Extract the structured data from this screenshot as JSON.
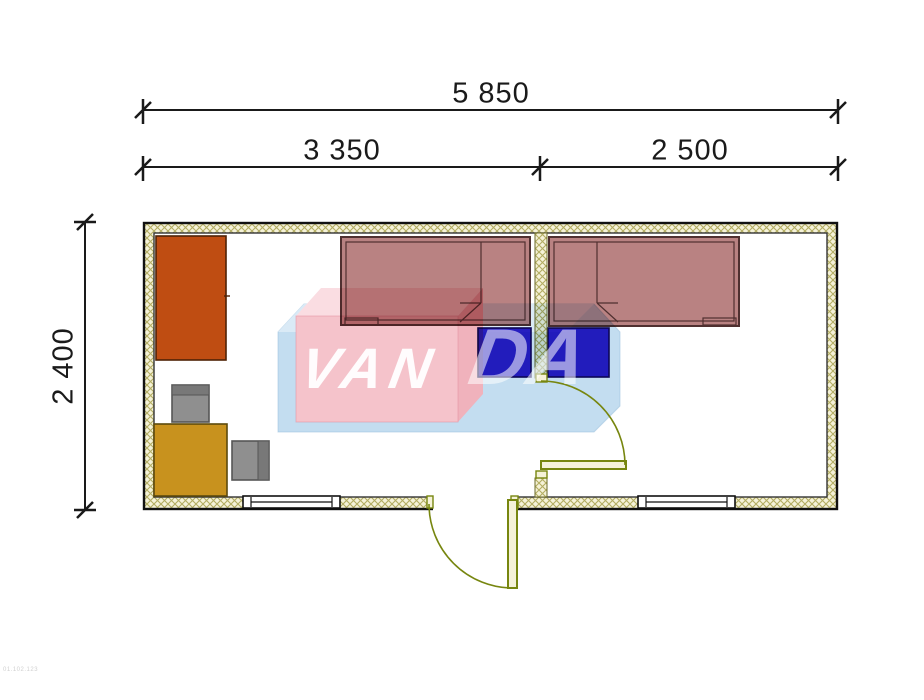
{
  "dimensions": {
    "total_width_label": "5 850",
    "left_room_width_label": "3 350",
    "right_room_width_label": "2 500",
    "depth_label": "2 400"
  },
  "watermark": {
    "part1": "VAN",
    "part2": "DA"
  },
  "corner_code": "01.102.123",
  "colors": {
    "wall_fill": "#f5f2d8",
    "wall_hatch": "#b3ad62",
    "outline": "#111111",
    "bed": "#b98282",
    "bed_outline": "#4f3030",
    "nightstand": "#2c20c8",
    "nightstand_outline": "#10085a",
    "wardrobe": "#bf4d12",
    "wardrobe_outline": "#4f2205",
    "table": "#c8921e",
    "table_outline": "#5c4a0d",
    "chair": "#8f8f8f",
    "chair_band": "#787878",
    "chair_outline": "#565656",
    "door": "#77860f",
    "door_leaf_fill": "#f5f2d8",
    "watermark_pink": "#f5c3cb",
    "watermark_pink_top": "#fadde2",
    "watermark_pink_side": "#f0b2bc",
    "watermark_blue": "#c3ddf0",
    "watermark_blue_top": "#daeaf6",
    "dimension_color": "#1a1a1a"
  }
}
